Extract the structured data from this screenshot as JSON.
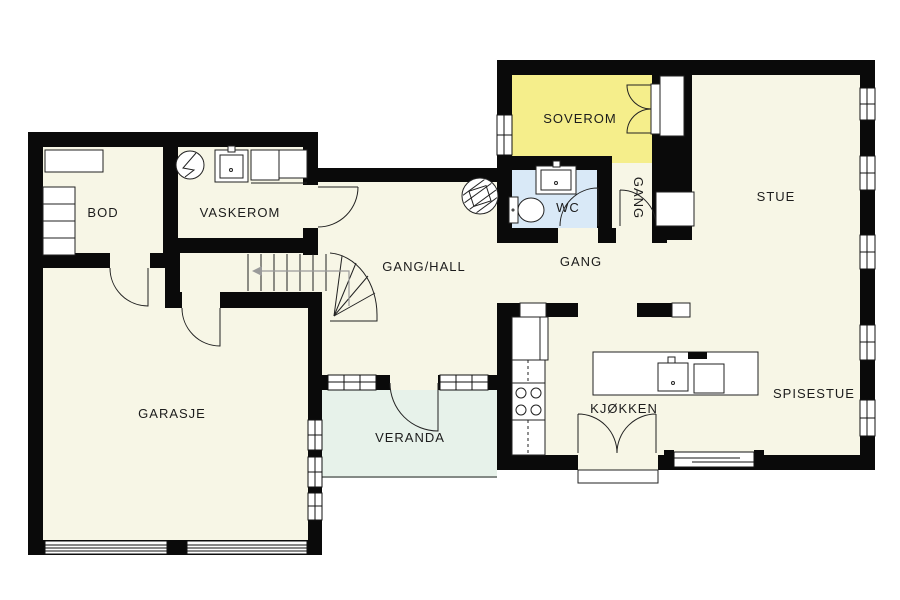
{
  "floorplan": {
    "title": "floor-plan",
    "colors": {
      "background": "#ffffff",
      "floor": "#f7f6e6",
      "soverom": "#f5ee8b",
      "wc": "#d9e9f7",
      "veranda": "#e7f2ea",
      "wall": "#0a0a0a",
      "label": "#1c1c1c"
    },
    "rooms": [
      {
        "id": "bod",
        "label": "BOD"
      },
      {
        "id": "vaskerom",
        "label": "VASKEROM"
      },
      {
        "id": "gang-hall",
        "label": "GANG/HALL"
      },
      {
        "id": "soverom",
        "label": "SOVEROM"
      },
      {
        "id": "wc",
        "label": "WC"
      },
      {
        "id": "gang-vertical",
        "label": "GANG"
      },
      {
        "id": "gang",
        "label": "GANG"
      },
      {
        "id": "stue",
        "label": "STUE"
      },
      {
        "id": "garasje",
        "label": "GARASJE"
      },
      {
        "id": "veranda",
        "label": "VERANDA"
      },
      {
        "id": "kjokken",
        "label": "KJØKKEN"
      },
      {
        "id": "spisestue",
        "label": "SPISESTUE"
      }
    ]
  }
}
